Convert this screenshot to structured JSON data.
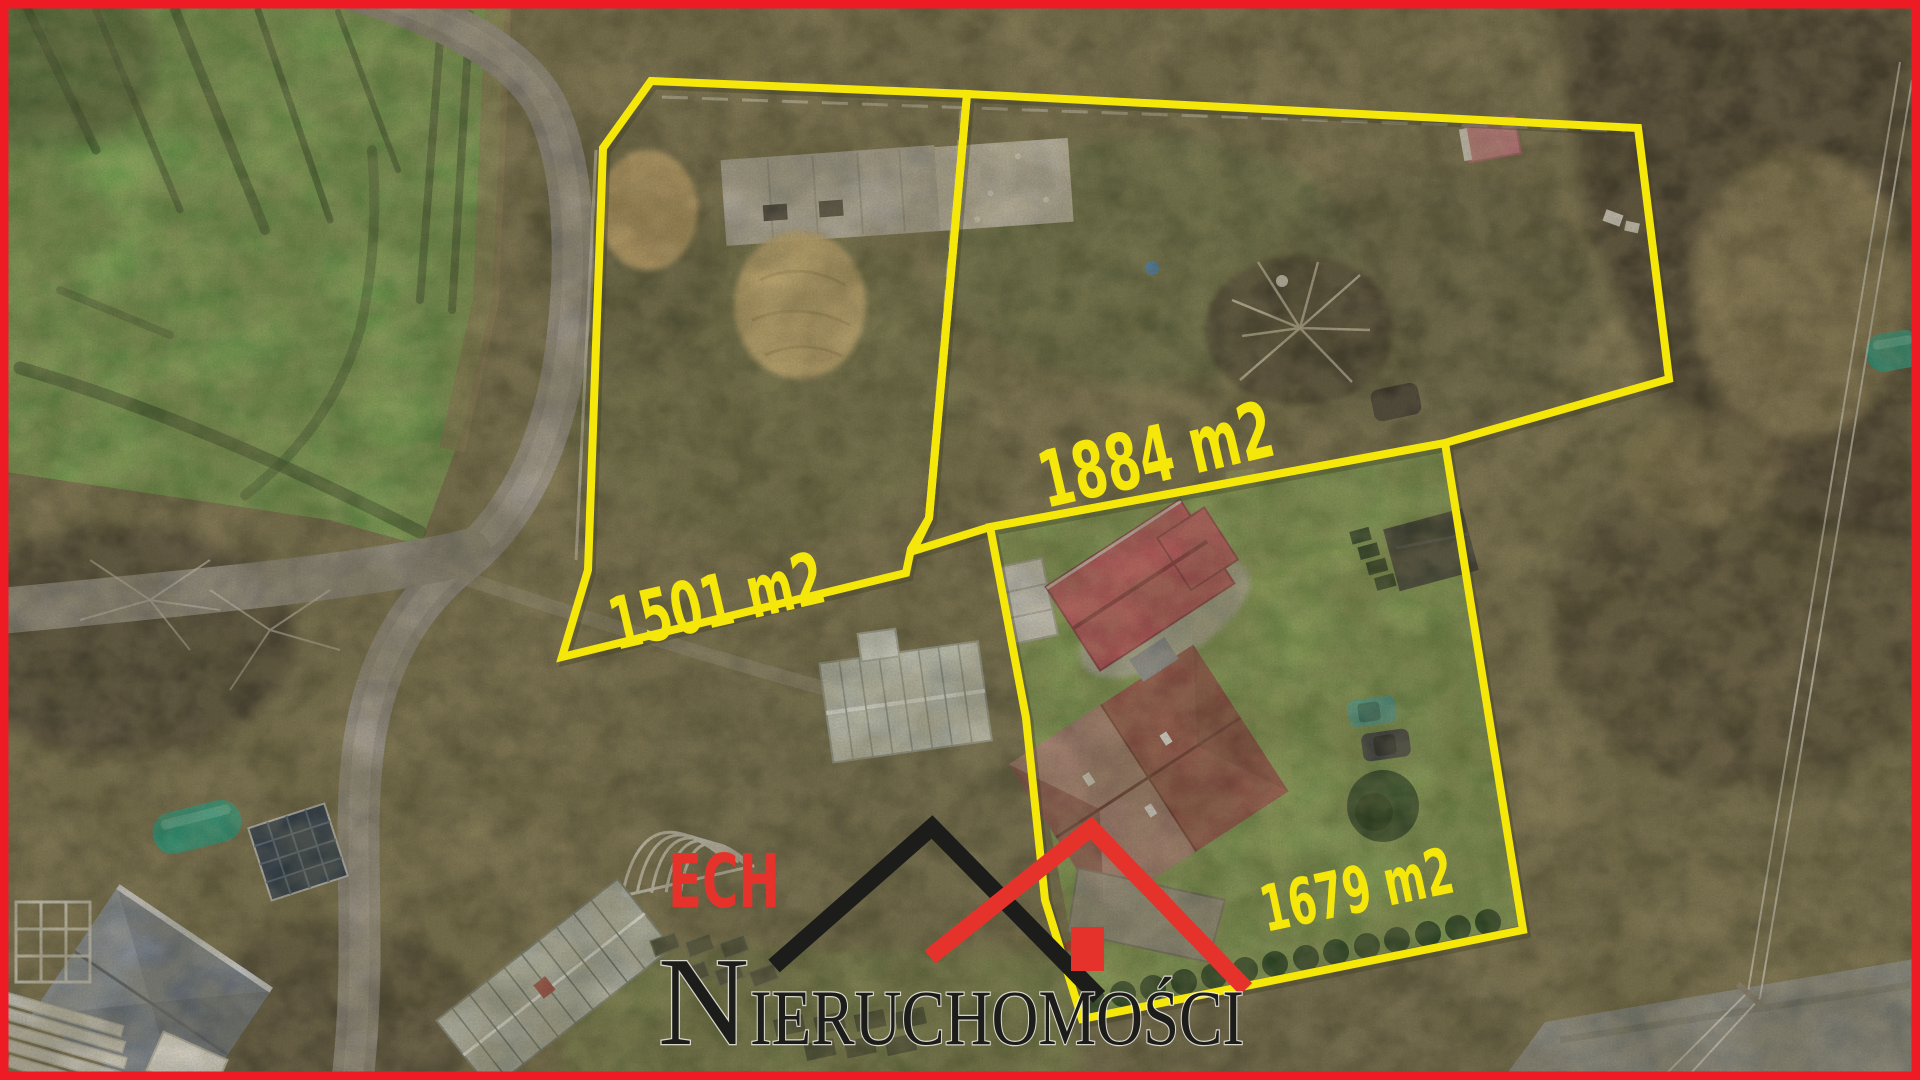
{
  "plots": [
    {
      "area_label": "1501 m2"
    },
    {
      "area_label": "1884 m2"
    },
    {
      "area_label": "1679 m2"
    }
  ],
  "logo": {
    "brand": "ECH",
    "brand_word": "NIERUCHOMOŚCI",
    "brand_initial": "N",
    "brand_rest": "IERUCHOMOŚCI"
  },
  "colors": {
    "boundary_yellow": "#f6e70b",
    "frame_red": "#ee1b24",
    "logo_red": "#e5332c",
    "logo_dark": "#1c1c1a"
  }
}
